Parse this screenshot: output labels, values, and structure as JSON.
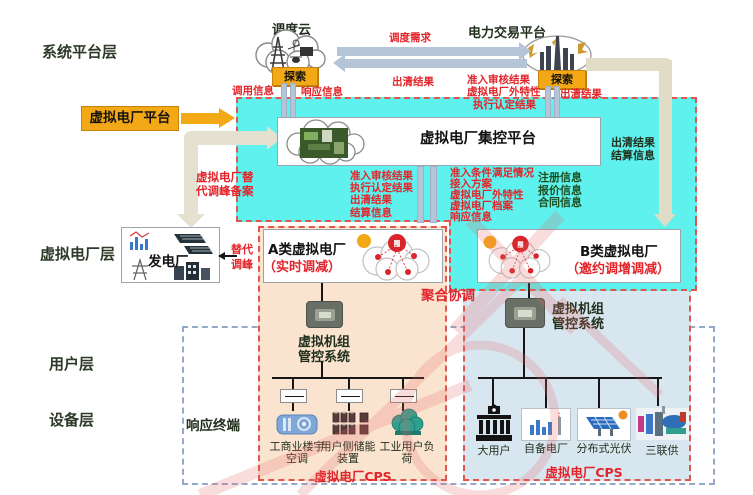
{
  "layers": {
    "system": "系统平台层",
    "vpp": "虚拟电厂层",
    "user": "用户层",
    "device": "设备层"
  },
  "top": {
    "dispatch_cloud_title": "调度云",
    "dispatch_probe": "探索",
    "trade_platform_title": "电力交易平台",
    "trade_probe": "探索",
    "call_info": "调用信息",
    "response_info": "响应信息",
    "dispatch_demand": "调度需求",
    "clearing_result_left": "出清结果",
    "access_audit_result": "准入审核结果",
    "vpp_external_char": "虚拟电厂外特性",
    "exec_confirm_result": "执行认定结果",
    "clearing_result_right": "出清结果"
  },
  "vpp_platform": {
    "label": "虚拟电厂平台",
    "filing_note": "虚拟电厂替\n代调峰备案"
  },
  "control_platform": {
    "title": "虚拟电厂集控平台",
    "left_group": "准入审核结果\n执行认定结果\n出清结果\n结算信息",
    "mid_group": "准入条件满足情况\n接入方案\n虚拟电厂外特性\n虚拟电厂档案\n响应信息",
    "reg_group": "注册信息\n报价信息\n合同信息",
    "right_group": "出清结果\n结算信息"
  },
  "power_plant": {
    "label": "发电厂",
    "replace_note": "替代\n调峰"
  },
  "aggregation_label": "聚合协调",
  "response_terminal_label": "响应终端",
  "plant_a": {
    "title": "A类虚拟电厂",
    "subtitle": "（实时调减）",
    "unit_system": "虚拟机组\n管控系统",
    "cps_label": "虚拟电厂CPS",
    "devices": [
      {
        "label": "工商业楼宇\n空调"
      },
      {
        "label": "用户侧储能\n装置"
      },
      {
        "label": "工业用户负\n荷"
      }
    ]
  },
  "plant_b": {
    "title": "B类虚拟电厂",
    "subtitle": "（邀约调增调减）",
    "unit_system": "虚拟机组\n管控系统",
    "cps_label": "虚拟电厂CPS",
    "devices": [
      {
        "label": "大用户"
      },
      {
        "label": "自备电厂"
      },
      {
        "label": "分布式光伏"
      },
      {
        "label": "三联供"
      }
    ]
  },
  "colors": {
    "cyan_panel": "#5ef1ed",
    "amber": "#f3a816",
    "red_text": "#e2252b",
    "dashed_border_red": "#e0564e",
    "panel_a_bg": "#fae4d0",
    "panel_b_bg": "#d8e6ef",
    "pipe_gray": "#b6c4d8",
    "pipe_tan": "#e0dcc6",
    "dark_text": "#22301e",
    "green_text": "#1f4d1f",
    "outer_dashed_blue": "#93a9c8"
  }
}
